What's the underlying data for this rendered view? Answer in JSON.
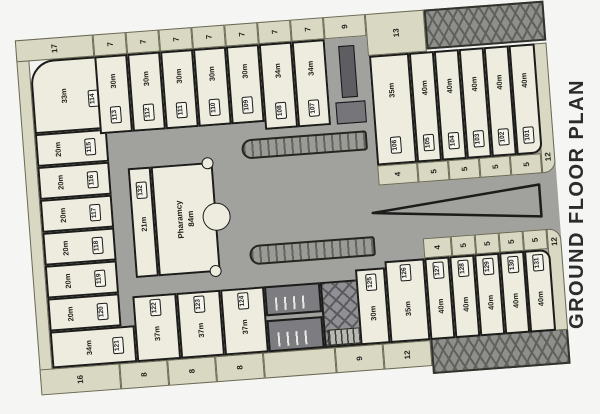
{
  "title": "GROUND FLOOR PLAN",
  "colors": {
    "road": "#a1a19e",
    "sidewalk": "#d9d8c3",
    "room_fill": "#edecdf",
    "wall": "#1c1c1a",
    "hatch_zone": "#8e8e8a"
  },
  "pharmacy": {
    "name": "Pharamcy",
    "area": "84m"
  },
  "room_132": {
    "number": "132",
    "area": "21m"
  },
  "left_column": [
    {
      "number": "114",
      "area": "33m"
    },
    {
      "number": "115",
      "area": "20m"
    },
    {
      "number": "116",
      "area": "20m"
    },
    {
      "number": "117",
      "area": "20m"
    },
    {
      "number": "118",
      "area": "20m"
    },
    {
      "number": "119",
      "area": "20m"
    },
    {
      "number": "120",
      "area": "20m"
    },
    {
      "number": "121",
      "area": "34m"
    }
  ],
  "top_row": [
    {
      "number": "113",
      "area": "30m"
    },
    {
      "number": "112",
      "area": "30m"
    },
    {
      "number": "111",
      "area": "30m"
    },
    {
      "number": "110",
      "area": "30m"
    },
    {
      "number": "109",
      "area": "30m"
    },
    {
      "number": "108",
      "area": "34m"
    },
    {
      "number": "107",
      "area": "34m"
    }
  ],
  "right_top": [
    {
      "number": "106",
      "area": "35m"
    },
    {
      "number": "105",
      "area": "40m"
    },
    {
      "number": "104",
      "area": "40m"
    },
    {
      "number": "103",
      "area": "40m"
    },
    {
      "number": "102",
      "area": "40m"
    },
    {
      "number": "101",
      "area": "40m"
    }
  ],
  "bottom_row": [
    {
      "number": "122",
      "area": "37m"
    },
    {
      "number": "123",
      "area": "37m"
    },
    {
      "number": "124",
      "area": "37m"
    }
  ],
  "right_bottom": [
    {
      "number": "125",
      "area": "30m"
    },
    {
      "number": "126",
      "area": "35m"
    },
    {
      "number": "127",
      "area": "40m"
    },
    {
      "number": "128",
      "area": "40m"
    },
    {
      "number": "129",
      "area": "40m"
    },
    {
      "number": "130",
      "area": "40m"
    },
    {
      "number": "131",
      "area": "40m"
    }
  ],
  "strips": {
    "top": [
      "17",
      "7",
      "7",
      "7",
      "7",
      "7",
      "7",
      "7",
      "9",
      "13"
    ],
    "bottom": [
      "16",
      "8",
      "8",
      "8",
      "9",
      "12"
    ],
    "inner_top": [
      "4",
      "5",
      "5",
      "5",
      "5",
      "12"
    ],
    "inner_bottom": [
      "4",
      "5",
      "5",
      "5",
      "5",
      "12"
    ]
  }
}
